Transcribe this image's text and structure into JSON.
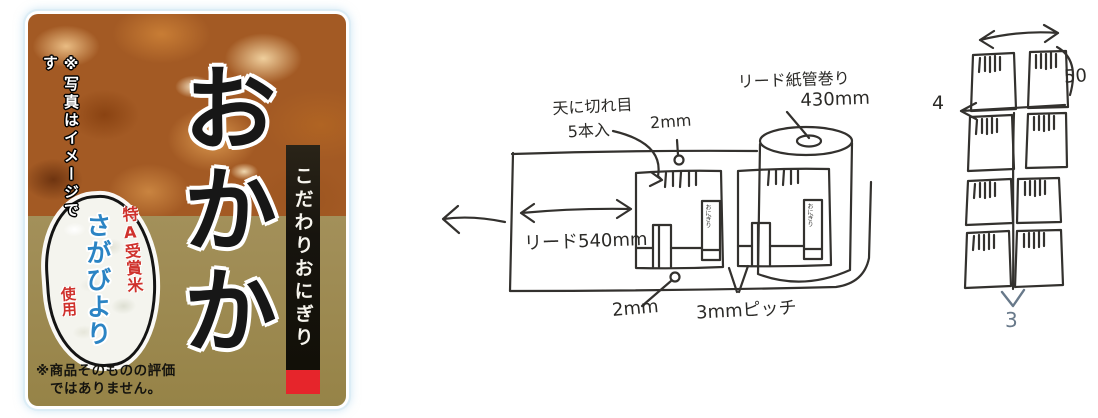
{
  "product_label": {
    "photo_note": "※写真はイメージです",
    "product_name": "おかか",
    "side_band": "こだわりおにぎり",
    "rice_badge": {
      "award_text": "特A受賞米",
      "brand_text": "さがびより",
      "use_text": "使用"
    },
    "disclaimer_line1": "※商品そのものの評価",
    "disclaimer_line2": "ではありません。",
    "colors": {
      "gold_background": "#9c8950",
      "side_band_black": "#17140e",
      "red_block": "#e6252b",
      "award_red": "#cf312c",
      "brand_blue": "#2b84c4"
    }
  },
  "roll_sketch": {
    "cut_note_line1": "天に切れ目",
    "cut_note_line2": "5本入",
    "top_dim": "2mm",
    "core_note_line1": "リード紙管巻り",
    "core_note_line2": "430mm",
    "lead_dim": "リード540mm",
    "bottom_dim": "2mm",
    "pitch_dim": "3mmピッチ",
    "mini_label": "おにぎり"
  },
  "grid_sketch": {
    "height_dim": "50",
    "row_gap_dim": "4",
    "col_gap_dim": "3"
  }
}
